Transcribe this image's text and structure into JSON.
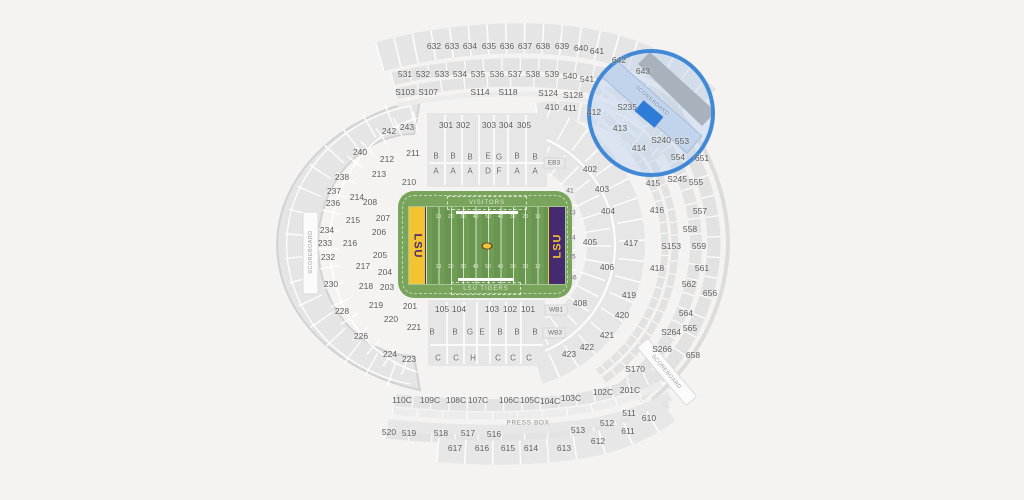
{
  "canvas": {
    "bg": "#f4f3f2"
  },
  "field": {
    "visitors": "VISITORS",
    "home": "LSU TIGERS",
    "endzone_left": "LSU",
    "endzone_right": "LSU",
    "yards": [
      "10",
      "20",
      "30",
      "40",
      "50",
      "40",
      "30",
      "20",
      "10"
    ],
    "colors": {
      "grass": "#709d54",
      "gold": "#f2c431",
      "purple": "#452a70"
    }
  },
  "highlight": {
    "fill": "#2e7cd7",
    "ring": "#4189d6"
  },
  "labels": {
    "sections": [
      {
        "t": "632",
        "x": 434,
        "y": 46
      },
      {
        "t": "633",
        "x": 452,
        "y": 46
      },
      {
        "t": "634",
        "x": 470,
        "y": 46
      },
      {
        "t": "635",
        "x": 489,
        "y": 46
      },
      {
        "t": "636",
        "x": 507,
        "y": 46
      },
      {
        "t": "637",
        "x": 525,
        "y": 46
      },
      {
        "t": "638",
        "x": 543,
        "y": 46
      },
      {
        "t": "639",
        "x": 562,
        "y": 46
      },
      {
        "t": "640",
        "x": 581,
        "y": 48
      },
      {
        "t": "641",
        "x": 597,
        "y": 51
      },
      {
        "t": "642",
        "x": 619,
        "y": 60
      },
      {
        "t": "643",
        "x": 643,
        "y": 71
      },
      {
        "t": "531",
        "x": 405,
        "y": 74
      },
      {
        "t": "532",
        "x": 423,
        "y": 74
      },
      {
        "t": "533",
        "x": 442,
        "y": 74
      },
      {
        "t": "534",
        "x": 460,
        "y": 74
      },
      {
        "t": "535",
        "x": 478,
        "y": 74
      },
      {
        "t": "536",
        "x": 497,
        "y": 74
      },
      {
        "t": "537",
        "x": 515,
        "y": 74
      },
      {
        "t": "538",
        "x": 533,
        "y": 74
      },
      {
        "t": "539",
        "x": 552,
        "y": 74
      },
      {
        "t": "540",
        "x": 570,
        "y": 76
      },
      {
        "t": "541",
        "x": 587,
        "y": 79
      },
      {
        "t": "S103",
        "x": 405,
        "y": 92
      },
      {
        "t": "S107",
        "x": 428,
        "y": 92
      },
      {
        "t": "S114",
        "x": 480,
        "y": 92
      },
      {
        "t": "S118",
        "x": 508,
        "y": 92
      },
      {
        "t": "S124",
        "x": 548,
        "y": 93
      },
      {
        "t": "S128",
        "x": 573,
        "y": 95
      },
      {
        "t": "410",
        "x": 552,
        "y": 107
      },
      {
        "t": "411",
        "x": 570,
        "y": 108
      },
      {
        "t": "412",
        "x": 594,
        "y": 112
      },
      {
        "t": "S235",
        "x": 627,
        "y": 107
      },
      {
        "t": "413",
        "x": 620,
        "y": 128
      },
      {
        "t": "S240",
        "x": 661,
        "y": 140
      },
      {
        "t": "414",
        "x": 639,
        "y": 148
      },
      {
        "t": "301",
        "x": 446,
        "y": 125
      },
      {
        "t": "302",
        "x": 463,
        "y": 125
      },
      {
        "t": "303",
        "x": 489,
        "y": 125
      },
      {
        "t": "304",
        "x": 506,
        "y": 125
      },
      {
        "t": "305",
        "x": 524,
        "y": 125
      },
      {
        "t": "242",
        "x": 389,
        "y": 131
      },
      {
        "t": "243",
        "x": 407,
        "y": 127
      },
      {
        "t": "240",
        "x": 360,
        "y": 152
      },
      {
        "t": "211",
        "x": 413,
        "y": 153
      },
      {
        "t": "212",
        "x": 387,
        "y": 159
      },
      {
        "t": "213",
        "x": 379,
        "y": 174
      },
      {
        "t": "238",
        "x": 342,
        "y": 177
      },
      {
        "t": "237",
        "x": 334,
        "y": 191
      },
      {
        "t": "214",
        "x": 357,
        "y": 197
      },
      {
        "t": "210",
        "x": 409,
        "y": 182
      },
      {
        "t": "236",
        "x": 333,
        "y": 203
      },
      {
        "t": "208",
        "x": 370,
        "y": 202
      },
      {
        "t": "215",
        "x": 353,
        "y": 220
      },
      {
        "t": "207",
        "x": 383,
        "y": 218
      },
      {
        "t": "234",
        "x": 327,
        "y": 230
      },
      {
        "t": "206",
        "x": 379,
        "y": 232
      },
      {
        "t": "233",
        "x": 325,
        "y": 243
      },
      {
        "t": "216",
        "x": 350,
        "y": 243
      },
      {
        "t": "232",
        "x": 328,
        "y": 257
      },
      {
        "t": "205",
        "x": 380,
        "y": 255
      },
      {
        "t": "217",
        "x": 363,
        "y": 266
      },
      {
        "t": "204",
        "x": 385,
        "y": 272
      },
      {
        "t": "230",
        "x": 331,
        "y": 284
      },
      {
        "t": "218",
        "x": 366,
        "y": 286
      },
      {
        "t": "203",
        "x": 387,
        "y": 287
      },
      {
        "t": "219",
        "x": 376,
        "y": 305
      },
      {
        "t": "201",
        "x": 410,
        "y": 306
      },
      {
        "t": "228",
        "x": 342,
        "y": 311
      },
      {
        "t": "220",
        "x": 391,
        "y": 319
      },
      {
        "t": "221",
        "x": 414,
        "y": 327
      },
      {
        "t": "226",
        "x": 361,
        "y": 336
      },
      {
        "t": "224",
        "x": 390,
        "y": 354
      },
      {
        "t": "223",
        "x": 409,
        "y": 359
      },
      {
        "t": "402",
        "x": 590,
        "y": 169
      },
      {
        "t": "403",
        "x": 602,
        "y": 189
      },
      {
        "t": "404",
        "x": 608,
        "y": 211
      },
      {
        "t": "405",
        "x": 590,
        "y": 242
      },
      {
        "t": "406",
        "x": 607,
        "y": 267
      },
      {
        "t": "408",
        "x": 580,
        "y": 303
      },
      {
        "t": "415",
        "x": 653,
        "y": 183
      },
      {
        "t": "416",
        "x": 657,
        "y": 210
      },
      {
        "t": "417",
        "x": 631,
        "y": 243
      },
      {
        "t": "418",
        "x": 657,
        "y": 268
      },
      {
        "t": "419",
        "x": 629,
        "y": 295
      },
      {
        "t": "420",
        "x": 622,
        "y": 315
      },
      {
        "t": "421",
        "x": 607,
        "y": 335
      },
      {
        "t": "422",
        "x": 587,
        "y": 347
      },
      {
        "t": "423",
        "x": 569,
        "y": 354
      },
      {
        "t": "553",
        "x": 682,
        "y": 141
      },
      {
        "t": "554",
        "x": 678,
        "y": 157
      },
      {
        "t": "651",
        "x": 702,
        "y": 158
      },
      {
        "t": "S245",
        "x": 677,
        "y": 179
      },
      {
        "t": "555",
        "x": 696,
        "y": 182
      },
      {
        "t": "557",
        "x": 700,
        "y": 211
      },
      {
        "t": "558",
        "x": 690,
        "y": 229
      },
      {
        "t": "S153",
        "x": 671,
        "y": 246
      },
      {
        "t": "559",
        "x": 699,
        "y": 246
      },
      {
        "t": "561",
        "x": 702,
        "y": 268
      },
      {
        "t": "562",
        "x": 689,
        "y": 284
      },
      {
        "t": "656",
        "x": 710,
        "y": 293
      },
      {
        "t": "564",
        "x": 686,
        "y": 313
      },
      {
        "t": "565",
        "x": 690,
        "y": 328
      },
      {
        "t": "S264",
        "x": 671,
        "y": 332
      },
      {
        "t": "S266",
        "x": 662,
        "y": 349
      },
      {
        "t": "658",
        "x": 693,
        "y": 355
      },
      {
        "t": "S170",
        "x": 635,
        "y": 369
      },
      {
        "t": "201C",
        "x": 630,
        "y": 390
      },
      {
        "t": "511",
        "x": 629,
        "y": 413
      },
      {
        "t": "610",
        "x": 649,
        "y": 418
      },
      {
        "t": "512",
        "x": 607,
        "y": 423
      },
      {
        "t": "513",
        "x": 578,
        "y": 430
      },
      {
        "t": "611",
        "x": 628,
        "y": 431
      },
      {
        "t": "612",
        "x": 598,
        "y": 441
      },
      {
        "t": "613",
        "x": 564,
        "y": 448
      },
      {
        "t": "105",
        "x": 442,
        "y": 309
      },
      {
        "t": "104",
        "x": 459,
        "y": 309
      },
      {
        "t": "103",
        "x": 492,
        "y": 309
      },
      {
        "t": "102",
        "x": 510,
        "y": 309
      },
      {
        "t": "101",
        "x": 528,
        "y": 309
      },
      {
        "t": "110C",
        "x": 402,
        "y": 400
      },
      {
        "t": "109C",
        "x": 430,
        "y": 400
      },
      {
        "t": "108C",
        "x": 456,
        "y": 400
      },
      {
        "t": "107C",
        "x": 478,
        "y": 400
      },
      {
        "t": "106C",
        "x": 509,
        "y": 400
      },
      {
        "t": "105C",
        "x": 530,
        "y": 400
      },
      {
        "t": "104C",
        "x": 550,
        "y": 401
      },
      {
        "t": "103C",
        "x": 571,
        "y": 398
      },
      {
        "t": "102C",
        "x": 603,
        "y": 392
      },
      {
        "t": "520",
        "x": 389,
        "y": 432
      },
      {
        "t": "519",
        "x": 409,
        "y": 433
      },
      {
        "t": "518",
        "x": 441,
        "y": 433
      },
      {
        "t": "517",
        "x": 468,
        "y": 433
      },
      {
        "t": "516",
        "x": 494,
        "y": 434
      },
      {
        "t": "617",
        "x": 455,
        "y": 448
      },
      {
        "t": "616",
        "x": 482,
        "y": 448
      },
      {
        "t": "615",
        "x": 508,
        "y": 448
      },
      {
        "t": "614",
        "x": 531,
        "y": 448
      }
    ],
    "letters": [
      {
        "t": "B",
        "x": 436,
        "y": 156
      },
      {
        "t": "B",
        "x": 453,
        "y": 156
      },
      {
        "t": "B",
        "x": 470,
        "y": 157
      },
      {
        "t": "E",
        "x": 488,
        "y": 156
      },
      {
        "t": "G",
        "x": 499,
        "y": 157
      },
      {
        "t": "B",
        "x": 517,
        "y": 156
      },
      {
        "t": "B",
        "x": 535,
        "y": 157
      },
      {
        "t": "A",
        "x": 436,
        "y": 171
      },
      {
        "t": "A",
        "x": 453,
        "y": 171
      },
      {
        "t": "A",
        "x": 470,
        "y": 171
      },
      {
        "t": "D",
        "x": 488,
        "y": 171
      },
      {
        "t": "F",
        "x": 499,
        "y": 171
      },
      {
        "t": "A",
        "x": 517,
        "y": 171
      },
      {
        "t": "A",
        "x": 535,
        "y": 171
      },
      {
        "t": "B",
        "x": 432,
        "y": 332
      },
      {
        "t": "B",
        "x": 455,
        "y": 332
      },
      {
        "t": "G",
        "x": 470,
        "y": 332
      },
      {
        "t": "E",
        "x": 482,
        "y": 332
      },
      {
        "t": "B",
        "x": 500,
        "y": 332
      },
      {
        "t": "B",
        "x": 517,
        "y": 332
      },
      {
        "t": "B",
        "x": 535,
        "y": 332
      },
      {
        "t": "C",
        "x": 438,
        "y": 358
      },
      {
        "t": "C",
        "x": 456,
        "y": 358
      },
      {
        "t": "H",
        "x": 473,
        "y": 358
      },
      {
        "t": "C",
        "x": 498,
        "y": 358
      },
      {
        "t": "C",
        "x": 513,
        "y": 358
      },
      {
        "t": "C",
        "x": 529,
        "y": 358
      }
    ],
    "small": [
      {
        "t": "EB3",
        "x": 554,
        "y": 163
      },
      {
        "t": "WB1",
        "x": 556,
        "y": 310
      },
      {
        "t": "WB3",
        "x": 555,
        "y": 333
      },
      {
        "t": "41",
        "x": 570,
        "y": 191
      },
      {
        "t": "43",
        "x": 572,
        "y": 213
      },
      {
        "t": "44",
        "x": 572,
        "y": 238
      },
      {
        "t": "45",
        "x": 572,
        "y": 257
      },
      {
        "t": "46",
        "x": 573,
        "y": 278
      }
    ],
    "special": [
      {
        "t": "SCOREBOARD",
        "x": 311,
        "y": 252,
        "rot": -90,
        "k": "sb"
      },
      {
        "t": "SCOREBOARD",
        "x": 652,
        "y": 101,
        "rot": 41,
        "k": "sb-blue"
      },
      {
        "t": "SCOREBOARD",
        "x": 666,
        "y": 372,
        "rot": 50,
        "k": "sb"
      },
      {
        "t": "PRESS BOX",
        "x": 528,
        "y": 423,
        "k": "pb"
      }
    ]
  }
}
